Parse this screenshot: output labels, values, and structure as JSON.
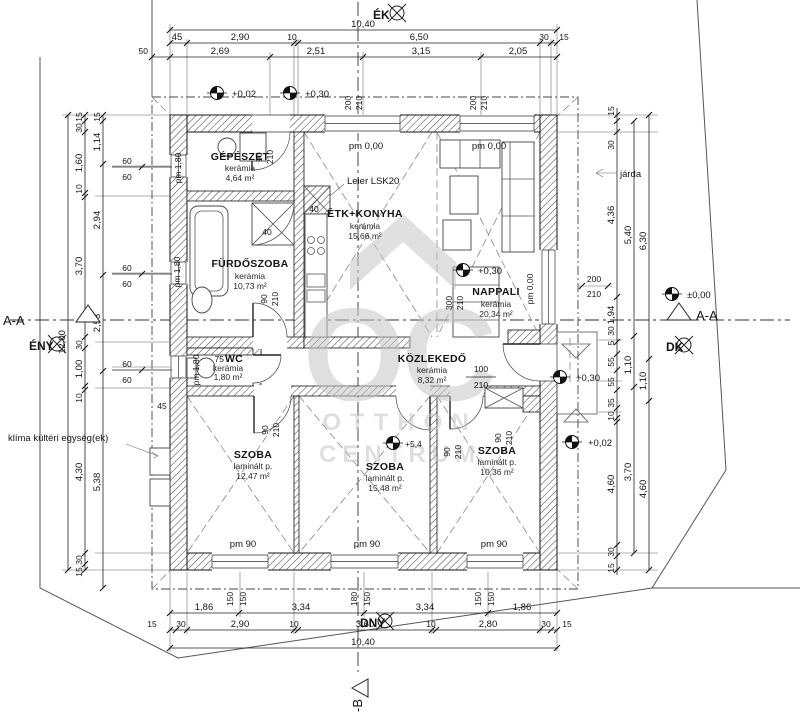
{
  "compass": {
    "ne": "ÉK",
    "nw": "ÉNY",
    "se": "DK",
    "sw": "DNY"
  },
  "sections": {
    "a": "A-A",
    "b": "-B"
  },
  "watermark": {
    "line1": "OTTHON",
    "line2": "CENTRUM",
    "logo": "OC"
  },
  "rooms": {
    "gepeszet": {
      "name": "GÉPÉSZET",
      "floor": "kerámia",
      "area": "4,64 m²"
    },
    "konyha": {
      "name": "ÉTK+KONYHA",
      "floor": "kerámia",
      "area": "15,66 m²"
    },
    "nappali": {
      "name": "NAPPALI",
      "floor": "kerámia",
      "area": "20,34 m²"
    },
    "furdo": {
      "name": "FÜRDŐSZOBA",
      "floor": "kerámia",
      "area": "10,73 m²"
    },
    "wc": {
      "name": "WC",
      "floor": "kerámia",
      "area": "1,80 m²"
    },
    "kozlekedo": {
      "name": "KÖZLEKEDŐ",
      "floor": "kerámia",
      "area": "8,32 m²"
    },
    "szoba1": {
      "name": "SZOBA",
      "floor": "laminált p.",
      "area": "12,47 m²"
    },
    "szoba2": {
      "name": "SZOBA",
      "floor": "laminált p.",
      "area": "15,48 m²"
    },
    "szoba3": {
      "name": "SZOBA",
      "floor": "laminált p.",
      "area": "10,36 m²"
    }
  },
  "annotations": {
    "chimney": "Leier LSK20",
    "klima": "klíma kültéri egység(ek)",
    "jarda": "járda"
  },
  "levels": {
    "l002": "+0,02",
    "l030": "+0,30",
    "l000": "±0,00",
    "l54": "+5,4"
  },
  "pm": {
    "p180": "pm 1,80",
    "p000": "pm 0,00",
    "p90": "pm 90"
  },
  "dims": {
    "v5": "5",
    "v10": "10",
    "v15": "15",
    "v30": "30",
    "v35": "35",
    "v40": "40",
    "v45": "45",
    "v50": "50",
    "v55": "55",
    "v60": "60",
    "v75": "75",
    "v90": "90",
    "v100": "100",
    "v100c": "1,00",
    "v110": "1,10",
    "v114": "1,14",
    "v104": "10,40",
    "v120": "12,00",
    "v150": "150",
    "v160": "1,60",
    "v180": "180",
    "v186": "1,86",
    "v194": "1,94",
    "v200": "200",
    "v205": "2,05",
    "v210": "210",
    "v251": "2,51",
    "v253": "2,53",
    "v269": "2,69",
    "v280": "2,80",
    "v290": "2,90",
    "v294": "2,94",
    "v300": "300",
    "v315": "3,15",
    "v334": "3,34",
    "v360": "3,60",
    "v370": "3,70",
    "v430": "4,30",
    "v436": "4,36",
    "v460": "4,60",
    "v538": "5,38",
    "v540": "5,40",
    "v630": "6,30",
    "v650": "6,50"
  }
}
